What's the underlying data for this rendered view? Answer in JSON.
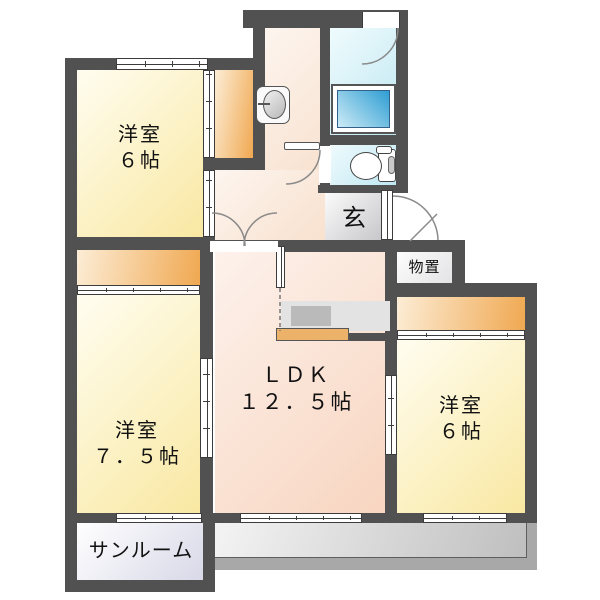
{
  "plan": {
    "rooms": {
      "west1": {
        "name": "洋室",
        "size": "６帖"
      },
      "west2": {
        "name": "洋室",
        "size": "７．５帖"
      },
      "ldk": {
        "name": "ＬＤＫ",
        "size": "１２．５帖"
      },
      "west3": {
        "name": "洋室",
        "size": "６帖"
      },
      "sunroom": {
        "name": "サンルーム"
      },
      "genkan": {
        "name": "玄"
      },
      "storage": {
        "name": "物置"
      }
    },
    "colors": {
      "wall": "#515151",
      "room_yellow": [
        "#fffdf0",
        "#f9e8a2"
      ],
      "ldk_peach": [
        "#fdf2ec",
        "#f8d5c0"
      ],
      "hallway_peach": [
        "#fdf5ef",
        "#f8e0cd"
      ],
      "closet_orange": [
        "#fcedd6",
        "#f0a851"
      ],
      "bath_cyan": [
        "#effbfd",
        "#bfe7f2"
      ],
      "tub_blue": [
        "#cdebf6",
        "#2f9ed3"
      ],
      "genkan_gray": [
        "#fbfbfb",
        "#c5c5c9"
      ],
      "storage_gray": [
        "#fdfdfd",
        "#e3e3e5"
      ],
      "sunroom_lavender": [
        "#ffffff",
        "#d8d8e8"
      ],
      "balcony_gray": [
        "#f4f4f4",
        "#bfbfbf"
      ],
      "parapet_gray": "#a8a8a8",
      "counter_gray": "#e3e3e3",
      "sink_gray": "#bababa",
      "counter_orange": "#edb269"
    }
  }
}
